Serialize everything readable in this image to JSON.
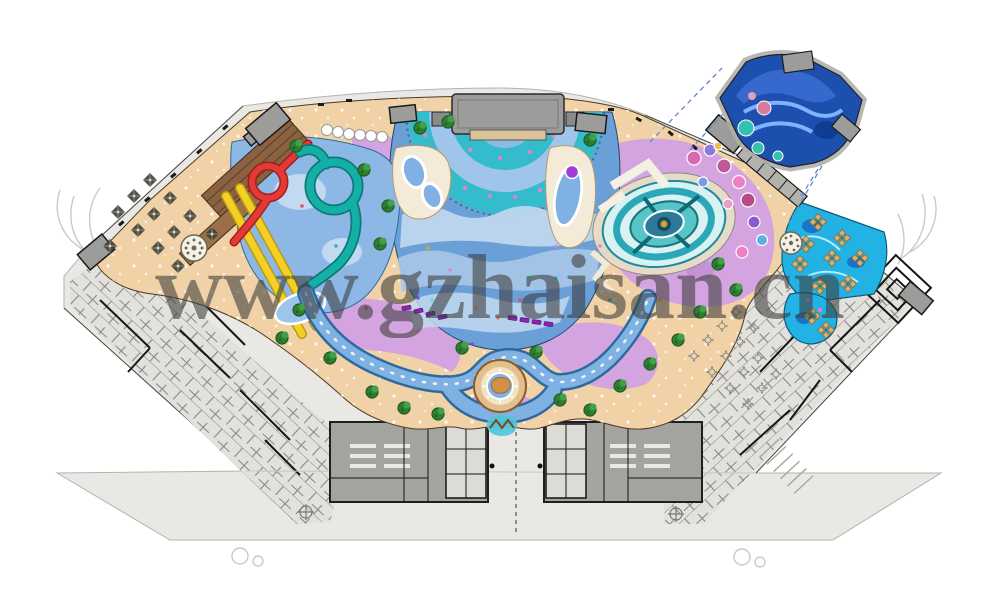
{
  "watermark": {
    "text": "www.gzhaisan.cn"
  },
  "palette": {
    "paper": "#ffffff",
    "plan_fill": "#e9e8e4",
    "plan_line": "#b5b3ae",
    "wall_ink": "#1f1f1f",
    "block_gray": "#a3a3a0",
    "building_gray": "#9c9c9a",
    "sand": "#f0d2a6",
    "sand_deep": "#e2c08e",
    "path_purple": "#d4a4e0",
    "path_purple_deep": "#c28fd6",
    "water_mid": "#6b9fd8",
    "water_light": "#c3d9f0",
    "pool_teal": "#35bccc",
    "river_blue": "#7fb2e2",
    "river_edge": "#2f6a9e",
    "pool_cyan": "#23b2e4",
    "wedge_blue": "#1d4fae",
    "slide_red": "#e53935",
    "slide_yellow": "#f4cf26",
    "slide_teal": "#14b0a8",
    "timber": "#8a6242",
    "tree_green": "#2e7d32",
    "tree_dark": "#1b5e20",
    "dot_pink": "#ef7fc4",
    "lounger_purple": "#8e24aa",
    "dashed_blue": "#5b8bd0",
    "watermark_gray": "#3d3d3d",
    "sketch": "#cbc9c4"
  }
}
